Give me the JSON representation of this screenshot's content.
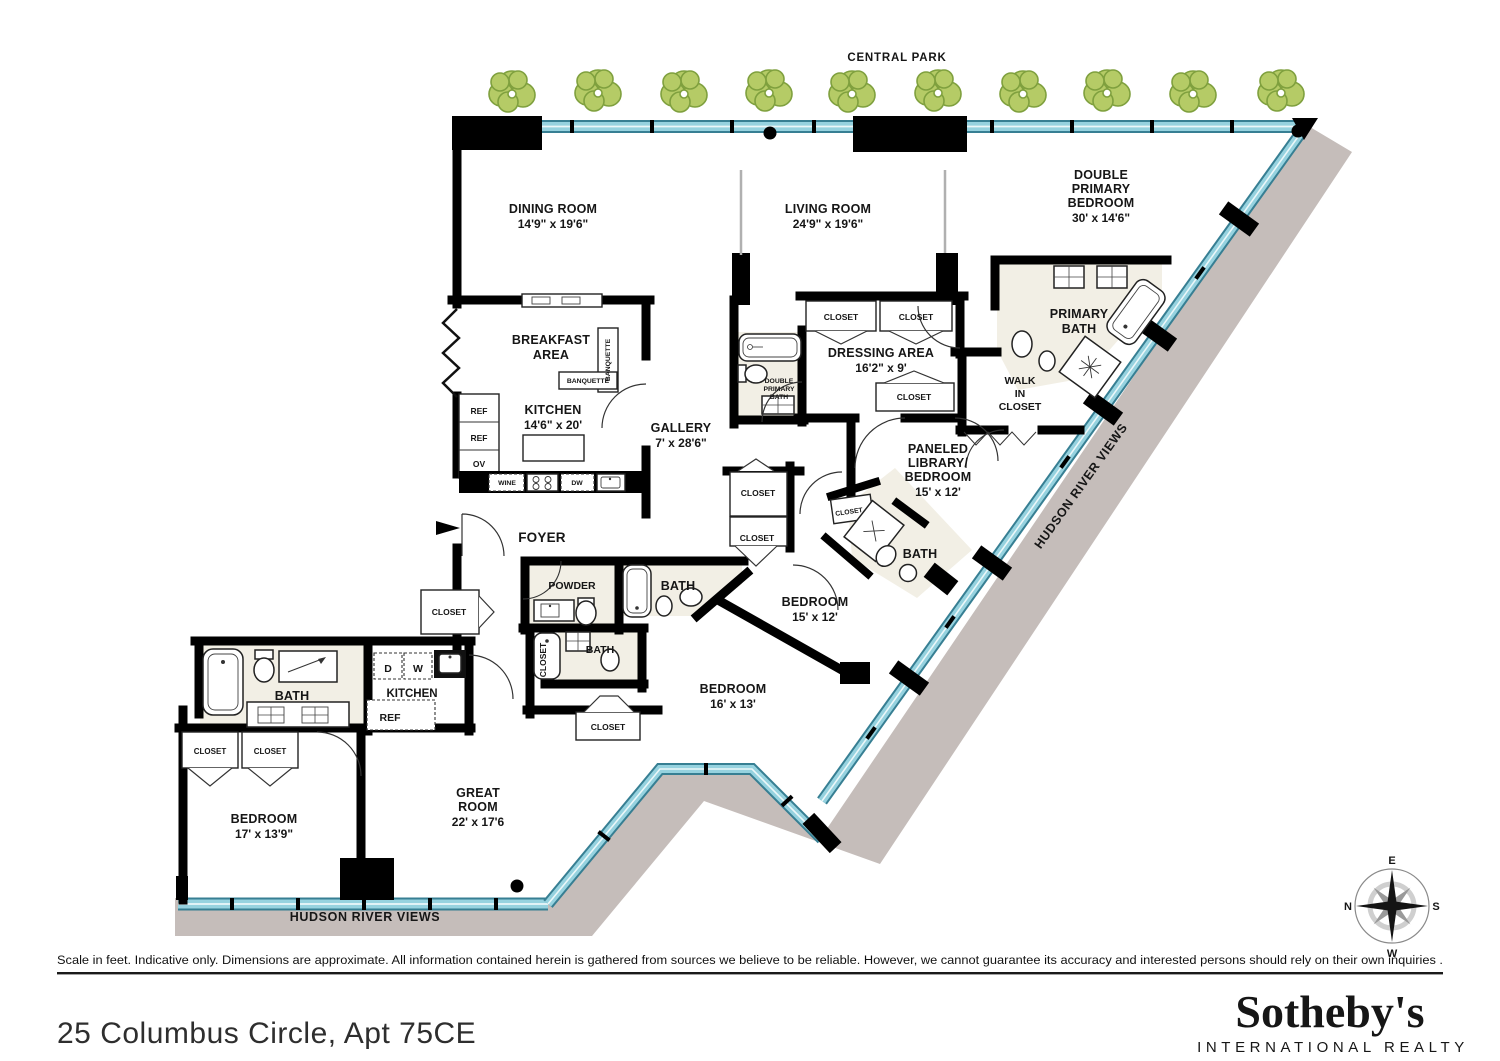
{
  "labels": {
    "central_park": "CENTRAL PARK",
    "hudson_river_views": "HUDSON RIVER VIEWS",
    "dining": {
      "name": "DINING ROOM",
      "dims": "14'9\" x 19'6\""
    },
    "living": {
      "name": "LIVING ROOM",
      "dims": "24'9\" x 19'6\""
    },
    "double_primary_bedroom": {
      "l1": "DOUBLE",
      "l2": "PRIMARY",
      "l3": "BEDROOM",
      "dims": "30' x 14'6\""
    },
    "breakfast": {
      "l1": "BREAKFAST",
      "l2": "AREA"
    },
    "banquette": "BANQUETTE",
    "kitchen": {
      "name": "KITCHEN",
      "dims": "14'6\" x 20'"
    },
    "gallery": {
      "name": "GALLERY",
      "dims": "7' x 28'6\""
    },
    "dressing": {
      "name": "DRESSING AREA",
      "dims": "16'2\" x 9'"
    },
    "double_primary_bath": {
      "l1": "DOUBLE",
      "l2": "PRIMARY",
      "l3": "BATH"
    },
    "primary_bath": {
      "l1": "PRIMARY",
      "l2": "BATH"
    },
    "walk_in_closet": {
      "l1": "WALK",
      "l2": "IN",
      "l3": "CLOSET"
    },
    "paneled_library": {
      "l1": "PANELED",
      "l2": "LIBRARY/",
      "l3": "BEDROOM",
      "dims": "15' x 12'"
    },
    "foyer": "FOYER",
    "powder": "POWDER",
    "bath": "BATH",
    "closet": "CLOSET",
    "bedroom15": {
      "name": "BEDROOM",
      "dims": "15' x 12'"
    },
    "bedroom16": {
      "name": "BEDROOM",
      "dims": "16' x 13'"
    },
    "bedroom17": {
      "name": "BEDROOM",
      "dims": "17' x 13'9\""
    },
    "great_room": {
      "l1": "GREAT",
      "l2": "ROOM",
      "dims": "22' x 17'6"
    },
    "kitchen2": "KITCHEN",
    "appliances": {
      "ref": "REF",
      "ov": "OV",
      "wine": "WINE",
      "dw": "DW",
      "d": "D",
      "w": "W"
    },
    "compass": {
      "n": "N",
      "e": "E",
      "s": "S",
      "w": "W"
    }
  },
  "footer": {
    "disclaimer": "Scale in feet. Indicative only. Dimensions are approximate. All information contained herein is gathered from sources we believe to be reliable. However, we cannot guarantee its accuracy and interested persons should rely on their own inquiries .",
    "title": "25 Columbus Circle, Apt 75CE",
    "brand_name": "Sotheby's",
    "brand_subtitle": "INTERNATIONAL REALTY"
  },
  "colors": {
    "wall": "#000000",
    "glass": "#96d2df",
    "glass_edge": "#377f93",
    "terrace": "#c5bdba",
    "tree_fill": "#b5cb66",
    "tree_stroke": "#7fa03e",
    "brand_navy": "#1d3661",
    "brand_gray": "#8e9093"
  }
}
